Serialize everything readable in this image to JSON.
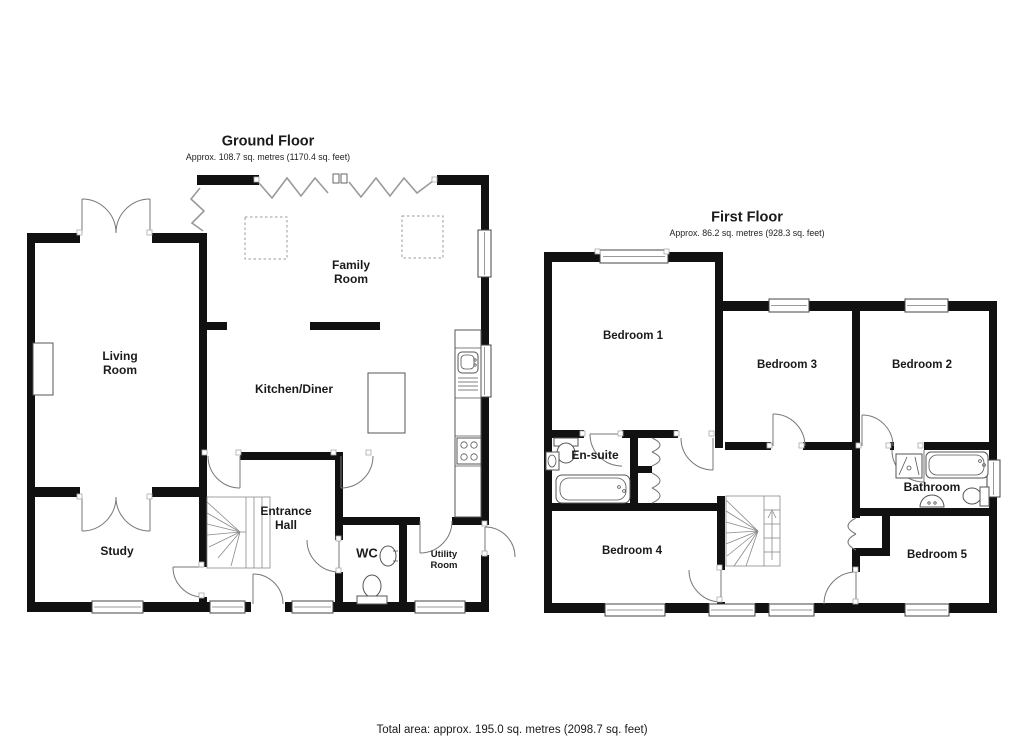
{
  "ground_floor": {
    "title": "Ground Floor",
    "area": "Approx. 108.7 sq. metres (1170.4 sq. feet)",
    "rooms": {
      "family_room": "Family\nRoom",
      "living_room": "Living\nRoom",
      "kitchen_diner": "Kitchen/Diner",
      "entrance_hall": "Entrance\nHall",
      "study": "Study",
      "wc": "WC",
      "utility_room": "Utility\nRoom"
    }
  },
  "first_floor": {
    "title": "First Floor",
    "area": "Approx. 86.2 sq. metres (928.3 sq. feet)",
    "rooms": {
      "bedroom_1": "Bedroom 1",
      "bedroom_2": "Bedroom 2",
      "bedroom_3": "Bedroom 3",
      "bedroom_4": "Bedroom 4",
      "bedroom_5": "Bedroom 5",
      "en_suite": "En-suite",
      "bathroom": "Bathroom"
    }
  },
  "footer": {
    "total_area": "Total area: approx. 195.0 sq. metres (2098.7 sq. feet)"
  },
  "colors": {
    "wall": "#111111",
    "door_line": "#777777",
    "glazing_line": "#9a9a9a",
    "background": "#ffffff",
    "text": "#1a1a1a"
  }
}
